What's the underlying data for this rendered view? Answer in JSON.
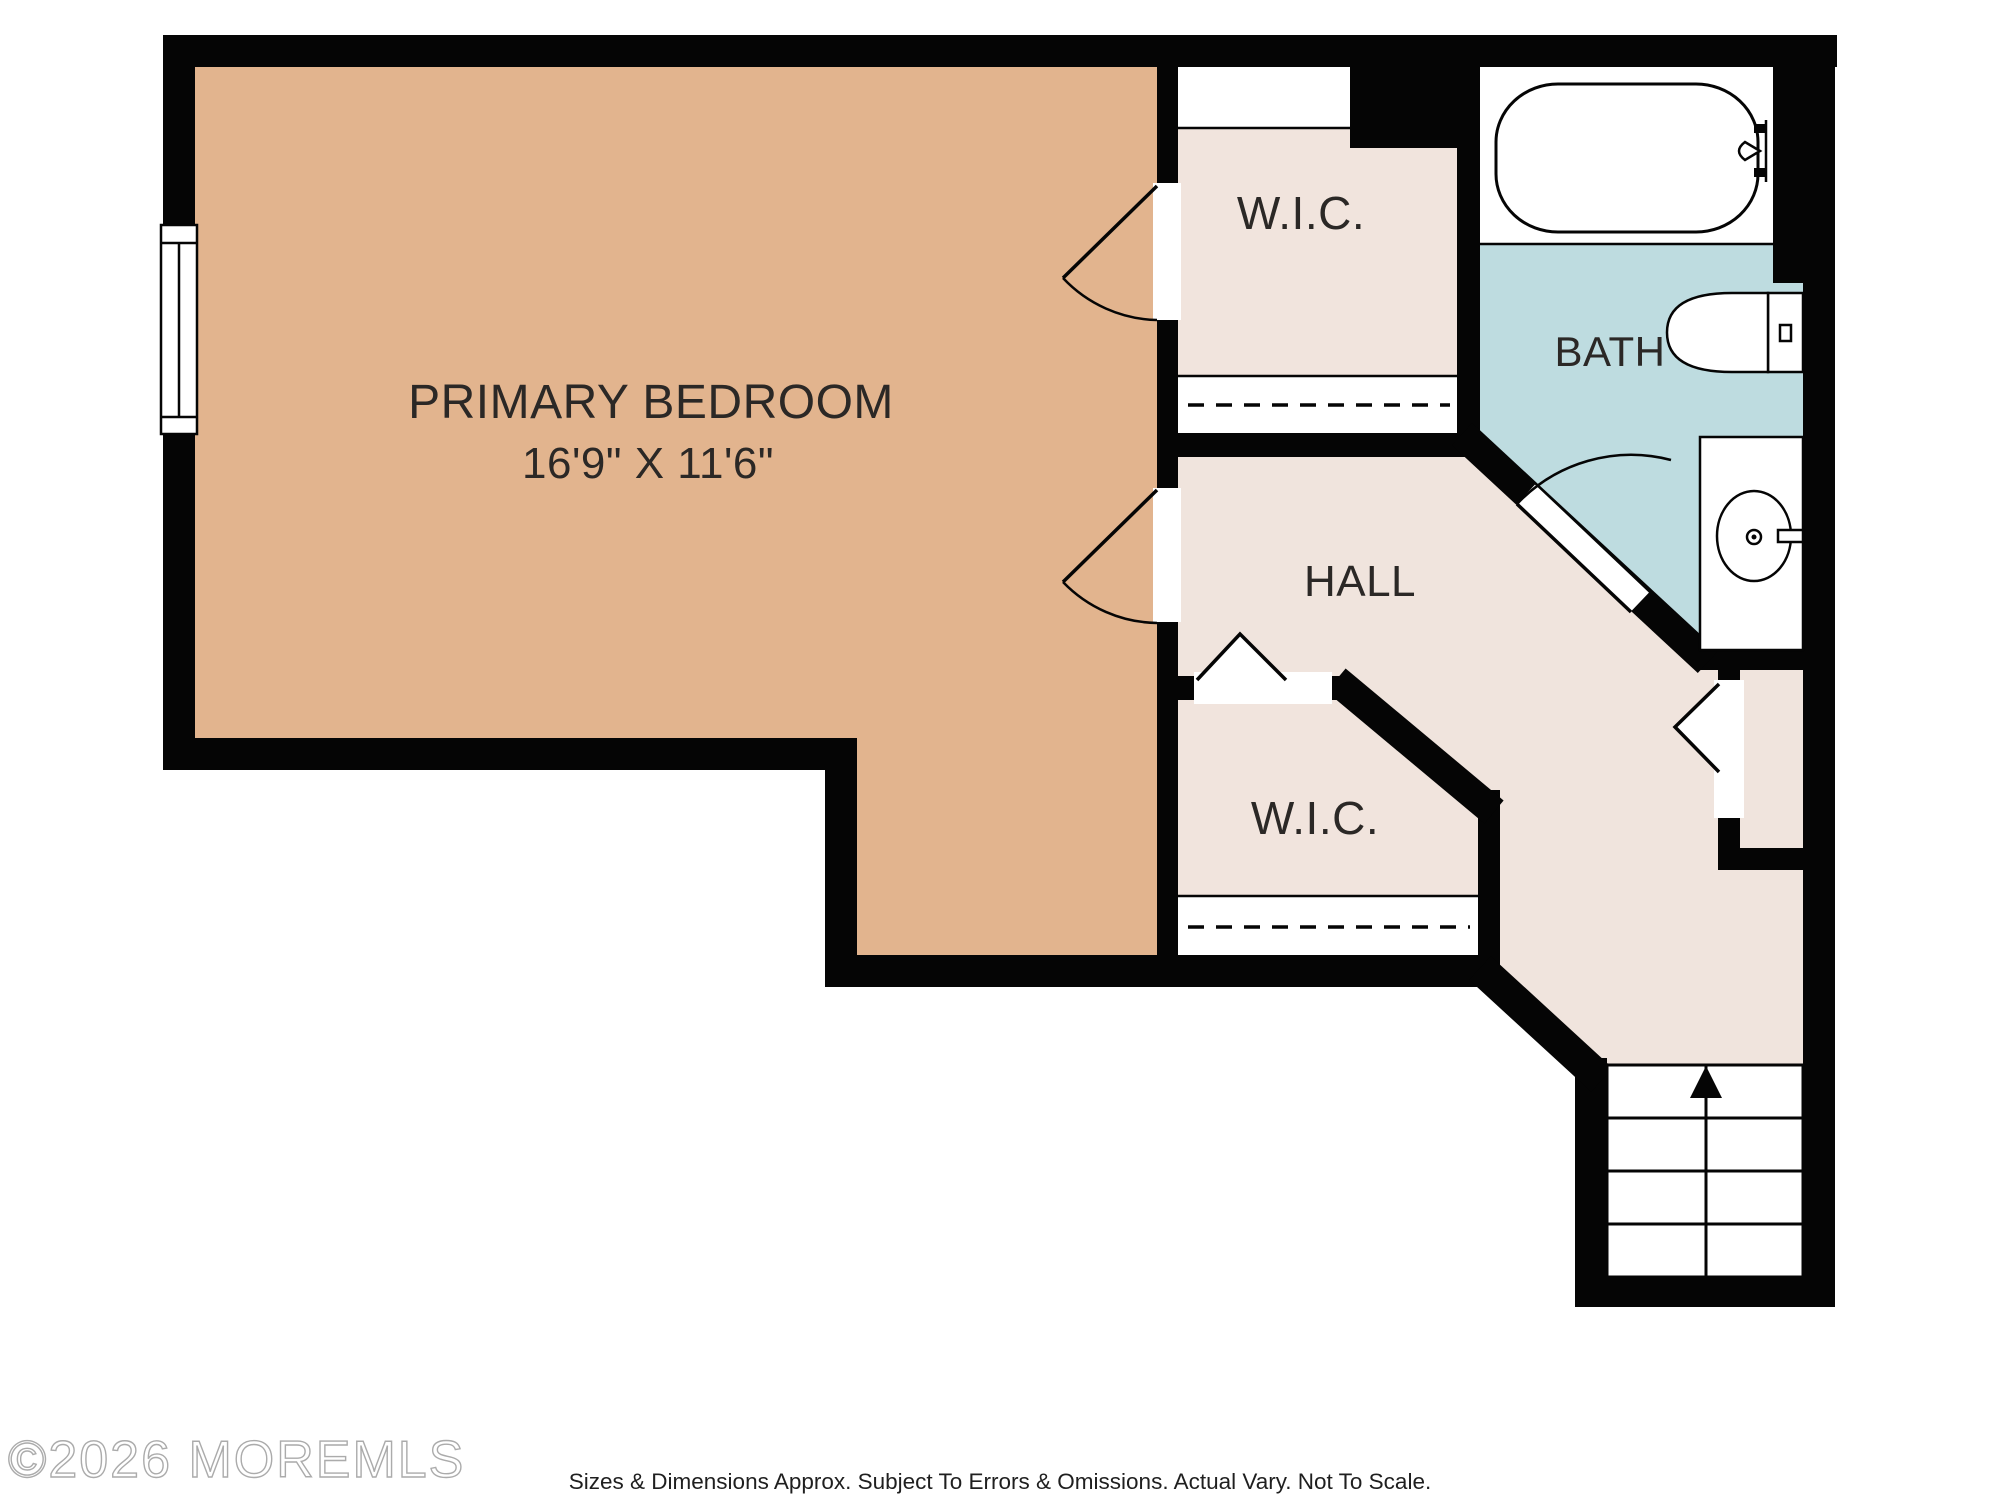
{
  "plan": {
    "type": "floor-plan",
    "rooms": [
      {
        "id": "primary-bedroom",
        "label": "PRIMARY BEDROOM",
        "dimensions": "16'9\" X 11'6\""
      },
      {
        "id": "wic-upper",
        "label": "W.I.C."
      },
      {
        "id": "bath",
        "label": "BATH"
      },
      {
        "id": "hall",
        "label": "HALL"
      },
      {
        "id": "wic-lower",
        "label": "W.I.C."
      },
      {
        "id": "stairs",
        "label": "",
        "direction": "up"
      }
    ],
    "fixtures": [
      "bathtub-icon",
      "toilet-icon",
      "sink-icon",
      "window-icon",
      "stairs-up-icon",
      "door-swing-icon",
      "closet-rod-line"
    ]
  },
  "colors": {
    "bedroom": "#e2b48e",
    "closet": "#f1e4dd",
    "hall": "#f0e4dd",
    "bath": "#bedce0",
    "wall": "#050505",
    "fixture_fill": "#ffffff",
    "label": "#2b2826"
  },
  "footer": {
    "watermark": "©2026 MOREMLS",
    "disclaimer": "Sizes & Dimensions Approx. Subject To Errors & Omissions. Actual Vary. Not To Scale."
  }
}
